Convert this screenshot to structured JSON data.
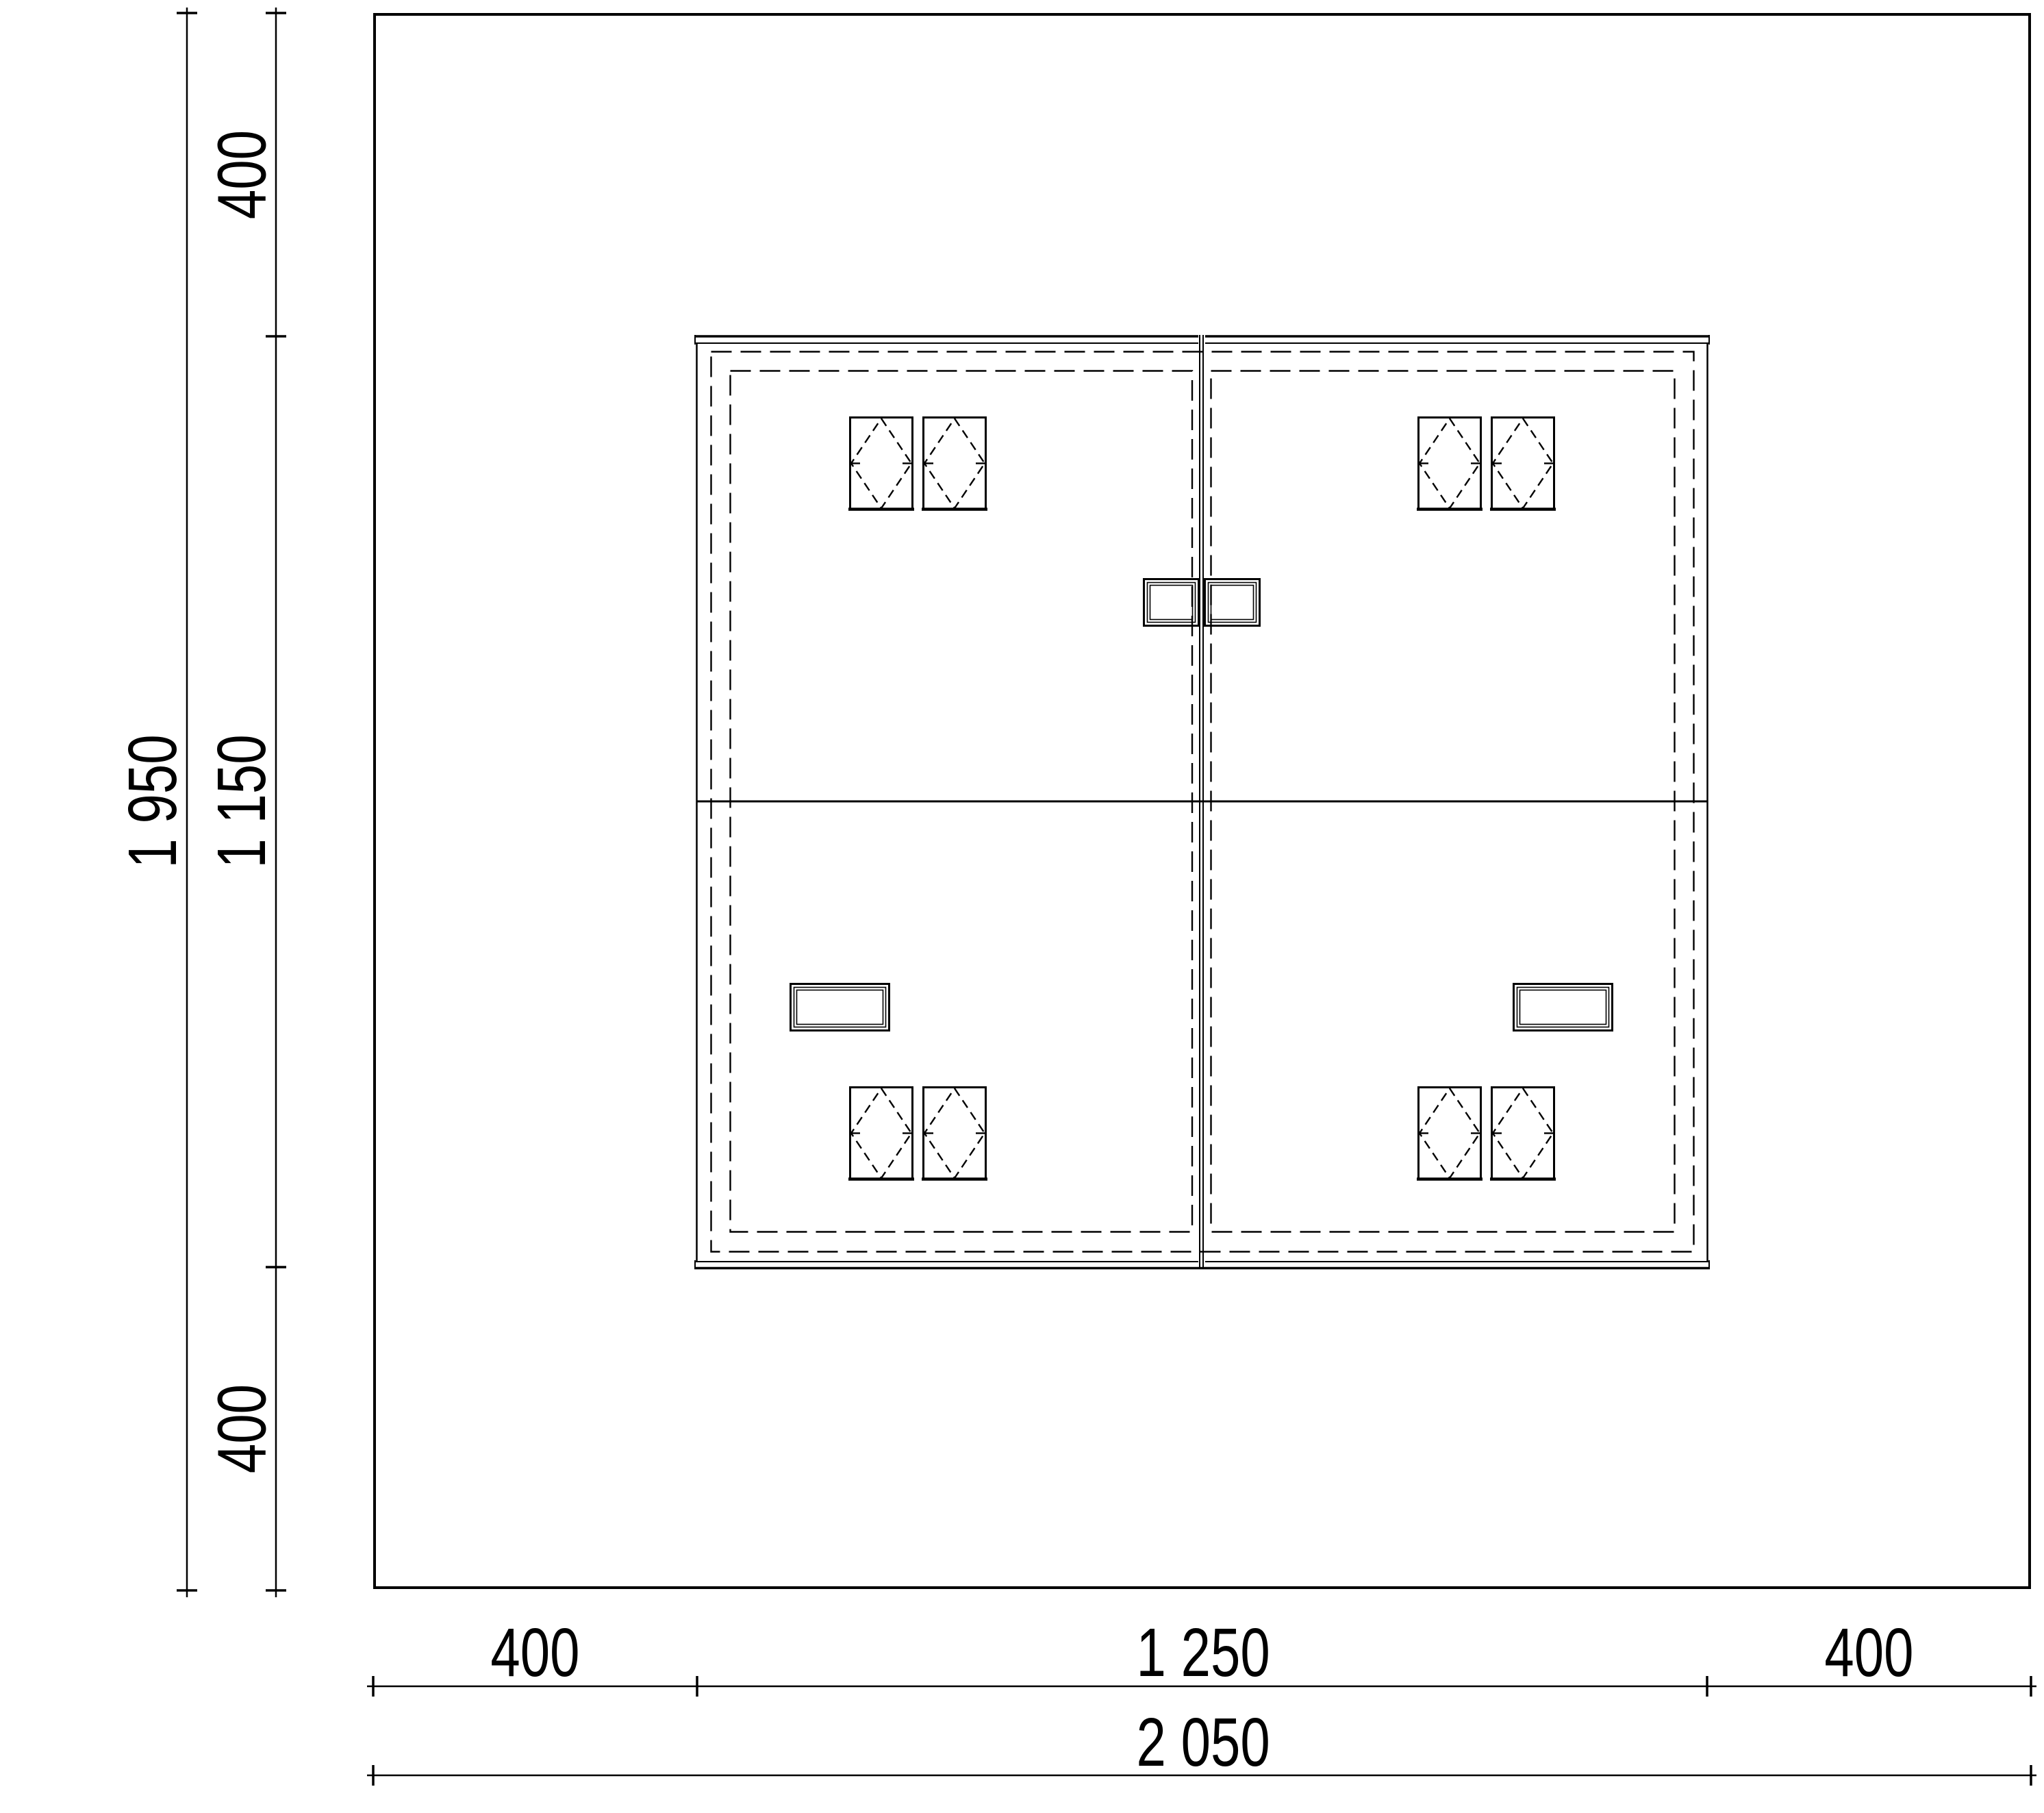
{
  "drawing_type": "technical-plan-drawing",
  "colors": {
    "line": "#000000",
    "background": "#ffffff"
  },
  "dimensions": {
    "left_total": "1 950",
    "left_segments": [
      "400",
      "1 150",
      "400"
    ],
    "bottom_segments": [
      "400",
      "1 250",
      "400"
    ],
    "bottom_total": "2 050"
  }
}
